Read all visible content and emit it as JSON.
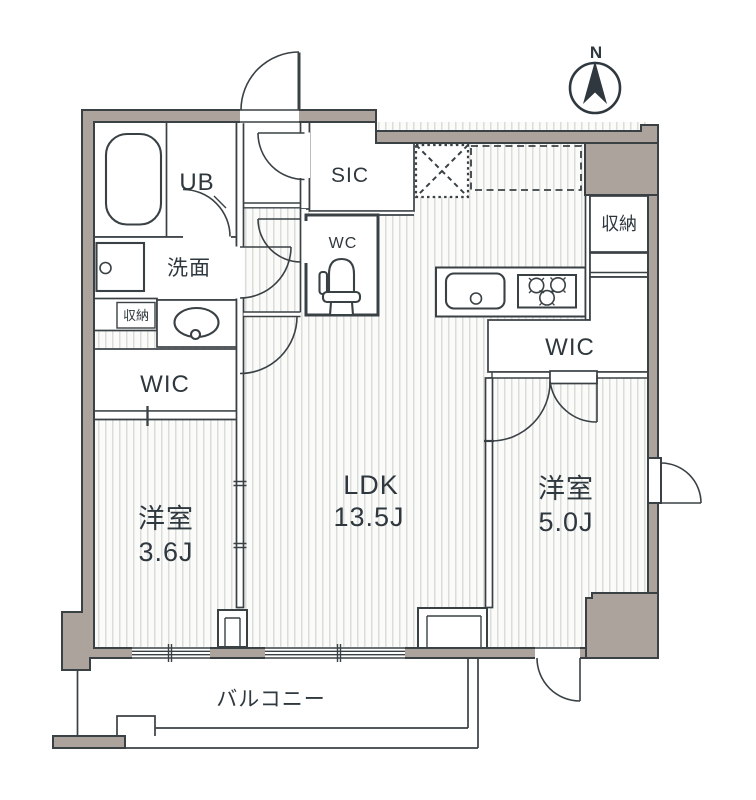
{
  "compass": {
    "north_label": "N"
  },
  "rooms": {
    "unit_bath": {
      "label": "UB"
    },
    "washroom": {
      "label": "洗面"
    },
    "storage_small": {
      "label": "収納"
    },
    "wic_left": {
      "label": "WIC"
    },
    "entrance_shoe_closet": {
      "label": "SIC"
    },
    "toilet": {
      "label": "WC"
    },
    "storage_right": {
      "label": "収納"
    },
    "wic_right": {
      "label": "WIC"
    },
    "bedroom_small": {
      "label": "洋室",
      "size": "3.6J"
    },
    "living": {
      "label": "LDK",
      "size": "13.5J"
    },
    "bedroom_large": {
      "label": "洋室",
      "size": "5.0J"
    },
    "balcony": {
      "label": "バルコニー"
    }
  },
  "colors": {
    "wall_fill": "#ACA39C",
    "outline": "#3A4145",
    "text": "#2F383E",
    "hatch_stripe": "#DBDDDB",
    "floor": "#FBFBFA"
  }
}
